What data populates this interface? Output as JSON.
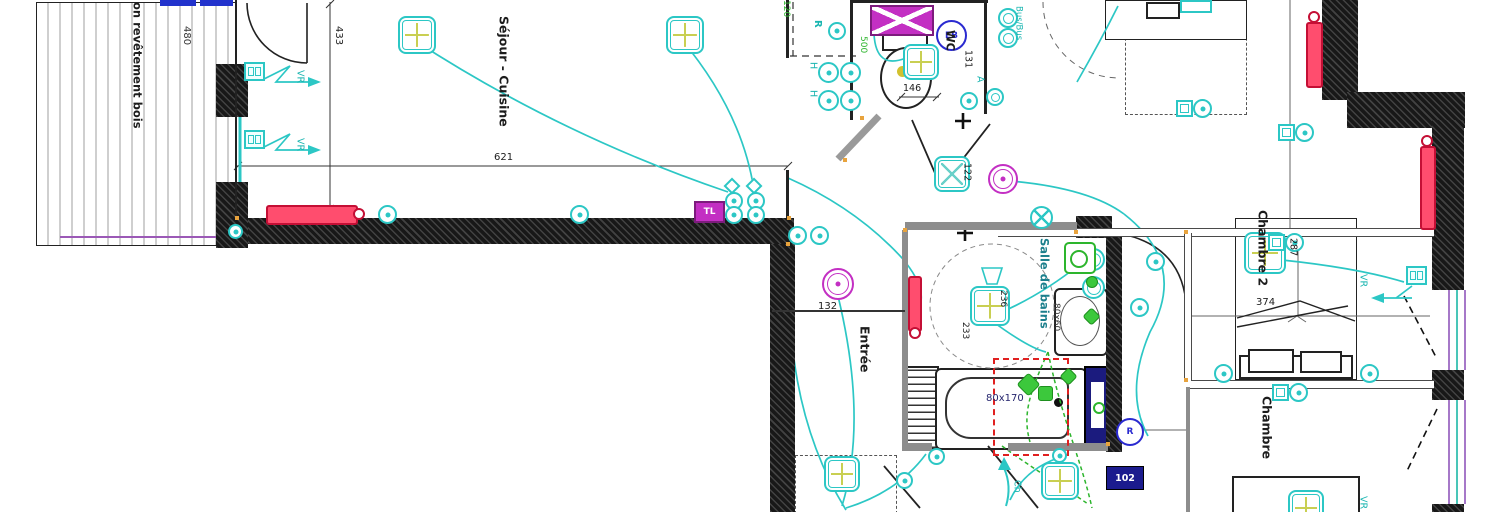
{
  "rooms": {
    "balcony_note": "on revêtement bois",
    "sejour": "Séjour - Cuisine",
    "entree": "Entrée",
    "wc": "WC",
    "sdb": "Salle de bains",
    "chambre2": "Chambre 2",
    "chambre": "Chambre"
  },
  "dims": {
    "d480": "480",
    "d433": "433",
    "d621": "621",
    "d120": "120",
    "d500": "500",
    "d146": "146",
    "d131": "131",
    "d122": "122",
    "d132": "132",
    "d233": "233",
    "d236": "236",
    "d287": "287",
    "d374": "374",
    "basin": "80x60",
    "bathtub": "80x170"
  },
  "labels": {
    "vr": "VR",
    "r_socket": "R",
    "h_socket": "H",
    "a_point": "A",
    "eb_badge": "EB",
    "bus": "Bus/Bus",
    "tl_badge": "TL",
    "ch_arrow": "Ch",
    "r_badge": "R",
    "room_badge": "102"
  },
  "colors": {
    "electrical_teal": "#2cc7c5",
    "detector_magenta": "#c32fc3",
    "radiator_red": "#ff4d6e",
    "wire_green": "#2db52d",
    "window_purple": "#a678c8",
    "badge_blue": "#2a2ad0",
    "panel_navy": "#1b1b8e"
  }
}
